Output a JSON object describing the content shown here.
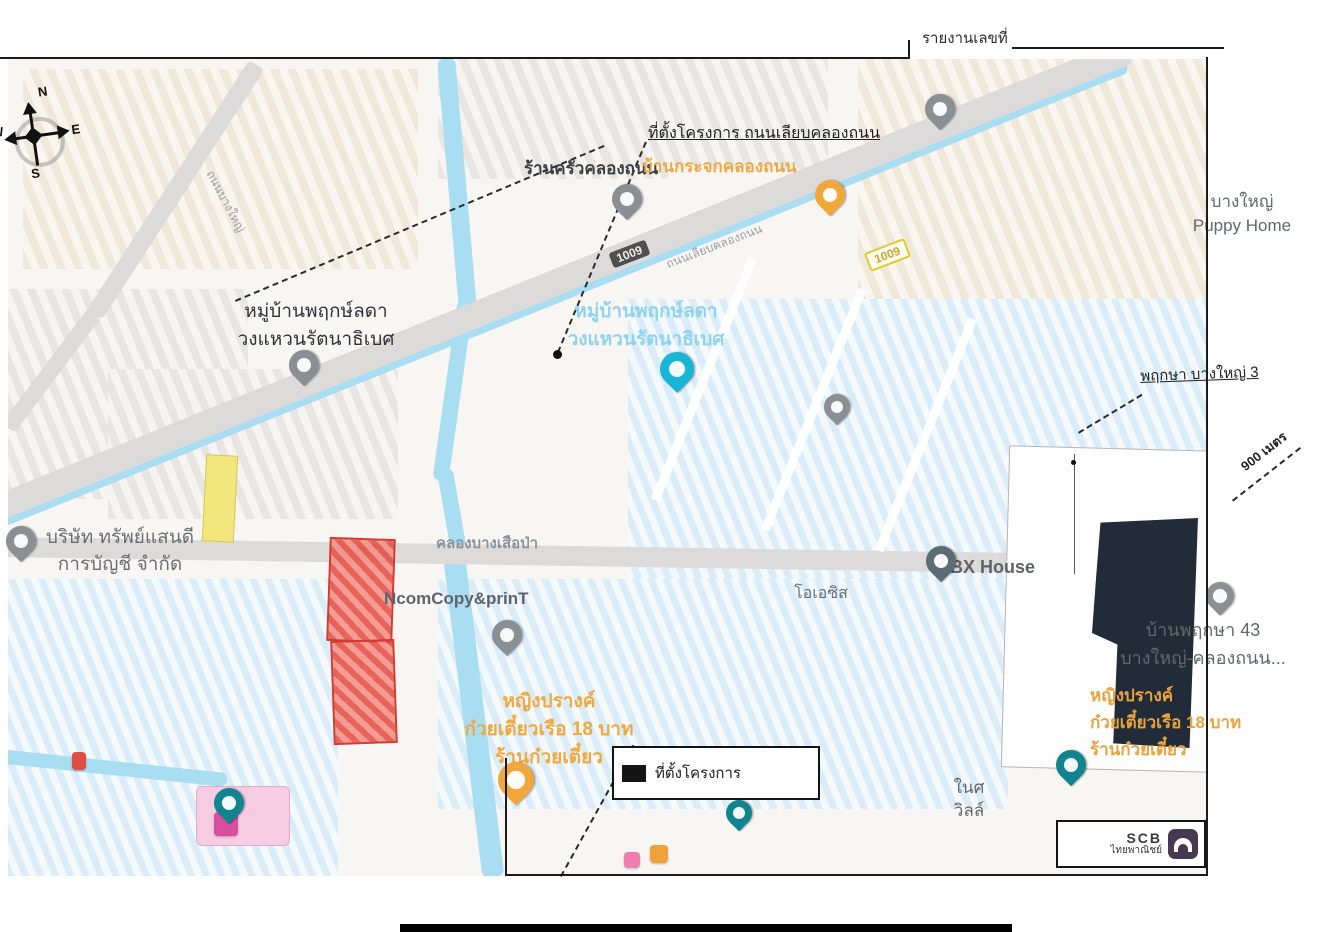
{
  "header": {
    "report_label": "รายงานเลขที่"
  },
  "compass": {
    "n": "N",
    "e": "E",
    "s": "S",
    "w": "W"
  },
  "legend": {
    "label": "ที่ตั้งโครงการ"
  },
  "scb": {
    "name": "SCB",
    "thai": "ไทยพาณิชย์"
  },
  "colors": {
    "water": "#a8ddf2",
    "site": "#222c38",
    "hl_yellow": "#f1e77c",
    "hl_red": "#e04b42",
    "hl_pink": "#f6cce3",
    "scb_purple": "#463a52",
    "pin_gray": "#8a8f94",
    "pin_orange": "#f2a73b",
    "pin_cyan": "#19b5d6",
    "pin_teal": "#11848f",
    "pin_slate": "#5d6b75",
    "poi_orange_text": "#eba63f",
    "poi_gray_text": "#63676c"
  },
  "map": {
    "shields": [
      {
        "num": "1009",
        "style": "dark",
        "x": 610,
        "y": 246
      },
      {
        "num": "1009",
        "style": "yellow",
        "x": 866,
        "y": 245
      }
    ],
    "labels": [
      {
        "id": "label-rankrua-khlongthanon",
        "lines": [
          "ร้านครัวคลองถนน"
        ],
        "x": 524,
        "y": 158,
        "size": 17,
        "color": "#3c4043",
        "weight": 600
      },
      {
        "id": "label-ban-krajok-khlongthanon",
        "lines": [
          "บ้านกระจกคลองถนน"
        ],
        "x": 642,
        "y": 156,
        "size": 17,
        "color": "#ecaa44",
        "weight": 700
      },
      {
        "id": "note-site-location",
        "lines": [
          "ที่ตั้งโครงการ ถนนเลียบคลองถนน"
        ],
        "x": 648,
        "y": 124,
        "size": 16,
        "color": "#1f1f1f",
        "weight": 500,
        "underline": true
      },
      {
        "id": "label-bangyai-puppy-home",
        "lines": [
          "บางใหญ่",
          "Puppy Home"
        ],
        "x": 1162,
        "y": 190,
        "size": 17,
        "color": "#63676c",
        "lh": 24,
        "center": 160
      },
      {
        "id": "label-muban-phruekslada",
        "lines": [
          "หมู่บ้านพฤกษ์ลดา",
          "วงแหวนรัตนาธิเบศ"
        ],
        "x": 198,
        "y": 298,
        "size": 19,
        "color": "#303439",
        "lh": 28,
        "center": 236,
        "weight": 500
      },
      {
        "id": "label-muban-phruekslada-area",
        "lines": [
          "หมู่บ้านพฤกษ์ลดา",
          "วงแหวนรัตนาธิเบศ"
        ],
        "x": 528,
        "y": 298,
        "size": 19,
        "color": "#8fd3ee",
        "lh": 28,
        "center": 236,
        "weight": 700
      },
      {
        "id": "note-pruksa-bangyai-3",
        "lines": [
          "พฤกษา บางใหญ่ 3"
        ],
        "x": 1140,
        "y": 368,
        "size": 15,
        "color": "#1f1f1f",
        "underline": true,
        "rotate": -2
      },
      {
        "id": "note-distance-900m",
        "lines": [
          "900 เมตร"
        ],
        "x": 1238,
        "y": 462,
        "size": 13,
        "color": "#222222",
        "rotate": -38,
        "weight": 600
      },
      {
        "id": "label-sapsaendee-accounting",
        "lines": [
          "บริษัท ทรัพย์แสนดี",
          "การบัญชี จำกัด"
        ],
        "x": 4,
        "y": 524,
        "size": 19,
        "color": "#6a6f75",
        "lh": 27,
        "center": 232
      },
      {
        "id": "label-khlong-bang-suea-pa",
        "lines": [
          "คลองบางเสือป่า"
        ],
        "x": 436,
        "y": 535,
        "size": 15,
        "color": "#8a949c",
        "weight": 600
      },
      {
        "id": "label-bx-house",
        "lines": [
          "BX House"
        ],
        "x": 950,
        "y": 556,
        "size": 18,
        "color": "#5f6469",
        "weight": 600
      },
      {
        "id": "label-ncomcopy-print",
        "lines": [
          "NcomCopy&prinT"
        ],
        "x": 384,
        "y": 588,
        "size": 17,
        "color": "#5f6469",
        "weight": 600
      },
      {
        "id": "label-oasis",
        "lines": [
          "โอเอซิส"
        ],
        "x": 794,
        "y": 584,
        "size": 16,
        "color": "#6a6f75"
      },
      {
        "id": "label-baan-pruksa-43",
        "lines": [
          "บ้านพฤกษา 43",
          "บางใหญ่-คลองถนน..."
        ],
        "x": 1098,
        "y": 616,
        "size": 18,
        "color": "#63676c",
        "lh": 28,
        "center": 210
      },
      {
        "id": "label-noodle-shop-right",
        "lines": [
          "หญิงปรางค์",
          "ก๋วยเตี๋ยวเรือ 18 บาท",
          "ร้านก๋วยเตี๋ยว"
        ],
        "x": 1090,
        "y": 682,
        "size": 17,
        "color": "#e8a33d",
        "weight": 700,
        "lh": 27
      },
      {
        "id": "label-noodle-shop-bottom",
        "lines": [
          "หญิงปรางค์",
          "ก๋วยเตี๋ยวเรือ 18 บาท",
          "ร้านก๋วยเตี๋ยว"
        ],
        "x": 436,
        "y": 688,
        "size": 19,
        "color": "#efa93f",
        "weight": 700,
        "lh": 28,
        "center": 226
      },
      {
        "id": "label-nai-villa",
        "lines": [
          "ในศ",
          "วิลล์"
        ],
        "x": 924,
        "y": 776,
        "size": 17,
        "color": "#63676c",
        "lh": 23,
        "center": 90
      },
      {
        "id": "label-road-liab-khlongthanon",
        "lines": [
          "ถนนเลียบคลองถนน"
        ],
        "x": 664,
        "y": 258,
        "size": 12,
        "color": "#9aa0a6",
        "rotate": -21
      },
      {
        "id": "label-road-bangyai",
        "lines": [
          "ถนนบางใหญ่"
        ],
        "x": 216,
        "y": 168,
        "size": 12,
        "color": "#9aa0a6",
        "rotate": 62
      }
    ],
    "pins": [
      {
        "id": "pin-top-right",
        "color": "gray",
        "x": 925,
        "y": 94,
        "s": 30
      },
      {
        "id": "pin-rankrua",
        "color": "gray",
        "x": 612,
        "y": 184,
        "s": 30
      },
      {
        "id": "pin-ban-krajok",
        "color": "orange",
        "x": 815,
        "y": 180,
        "s": 30
      },
      {
        "id": "pin-muban-phruekslada",
        "color": "gray",
        "x": 289,
        "y": 350,
        "s": 30
      },
      {
        "id": "pin-phruekslada-area",
        "color": "cyan",
        "x": 660,
        "y": 352,
        "s": 34
      },
      {
        "id": "pin-mid-right",
        "color": "gray",
        "x": 824,
        "y": 394,
        "s": 26
      },
      {
        "id": "pin-sapsaendee",
        "color": "gray",
        "x": 6,
        "y": 526,
        "s": 30
      },
      {
        "id": "pin-bx-house",
        "color": "slate",
        "x": 926,
        "y": 546,
        "s": 30
      },
      {
        "id": "pin-ncomcopy",
        "color": "gray",
        "x": 492,
        "y": 620,
        "s": 30
      },
      {
        "id": "pin-baan-pruksa-43",
        "color": "gray",
        "x": 1206,
        "y": 582,
        "s": 28
      },
      {
        "id": "pin-noodle-shop",
        "color": "orange",
        "x": 498,
        "y": 762,
        "s": 36
      },
      {
        "id": "pin-bottom-left",
        "color": "teal",
        "x": 214,
        "y": 788,
        "s": 30
      },
      {
        "id": "pin-bottom-center",
        "color": "teal",
        "x": 726,
        "y": 800,
        "s": 26
      },
      {
        "id": "pin-bottom-right",
        "color": "teal",
        "x": 1056,
        "y": 750,
        "s": 30
      }
    ]
  }
}
